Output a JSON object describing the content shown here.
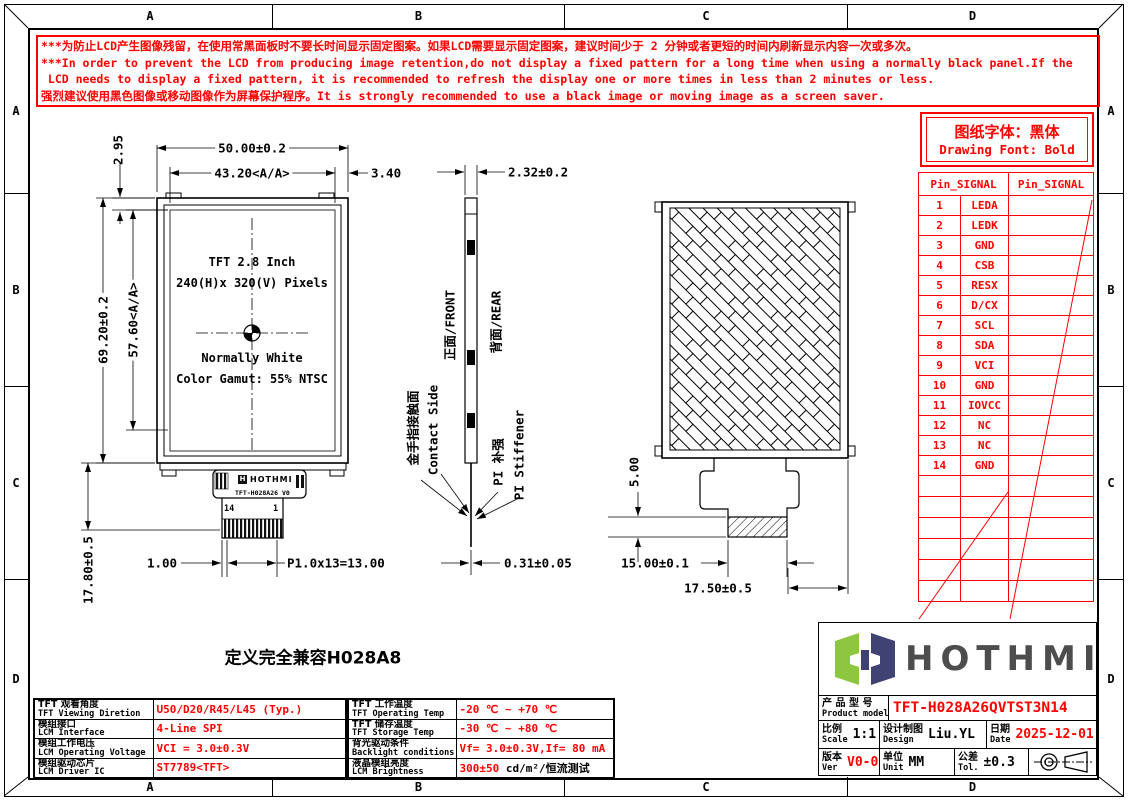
{
  "colors": {
    "red": "#ff0000",
    "logo_green": "#8dc63f",
    "logo_navy": "#3f4273",
    "logo_text": "#4d4d4d"
  },
  "grid": {
    "top": [
      "A",
      "B",
      "C",
      "D"
    ],
    "bottom": [
      "A",
      "B",
      "C",
      "D"
    ],
    "left": [
      "A",
      "B",
      "C",
      "D"
    ],
    "right": [
      "A",
      "B",
      "C",
      "D"
    ]
  },
  "warning": {
    "lines": [
      "***为防止LCD产生图像残留，在使用常黑面板时不要长时间显示固定图案。如果LCD需要显示固定图案，建议时间少于 2 分钟或者更短的时间内刷新显示内容一次或多次。",
      "***In order to prevent the LCD from producing image retention,do not display a fixed pattern for a long time when using a normally black panel.If the",
      " LCD needs to display a fixed pattern, it is recommended to refresh the display one or more times in less than 2 minutes or less.",
      "强烈建议使用黑色图像或移动图像作为屏幕保护程序。It is strongly recommended to use a black image or moving image as a screen saver."
    ]
  },
  "front_view": {
    "dim_width": "50.00±0.2",
    "dim_width_aa": "43.20<A/A>",
    "dim_side_margin": "3.40",
    "dim_top_margin": "2.95",
    "dim_height": "69.20±0.2",
    "dim_height_aa": "57.60<A/A>",
    "dim_tail": "17.80±0.5",
    "dim_pin_edge": "1.00",
    "dim_pitch": "P1.0x13=13.00",
    "screen_lines_top": [
      "TFT 2.8 Inch",
      "240(H)x 320(V) Pixels"
    ],
    "screen_lines_bottom": [
      "Normally White",
      "Color Gamut: 55% NTSC"
    ],
    "fpc_brand": "HOTHMI",
    "fpc_logo_letter": "H",
    "fpc_model": "TFT-H028A26 V0",
    "pin_first": "14",
    "pin_last": "1"
  },
  "side_view": {
    "dim_thickness": "2.32±0.2",
    "dim_fpc_thickness": "0.31±0.05",
    "label_front": "正面/FRONT",
    "label_rear": "背面/REAR",
    "label_contact_cn": "金手指接触面",
    "label_contact_en": "Contact Side",
    "label_stiffener_cn": "PI 补强",
    "label_stiffener_en": "PI Stiffener"
  },
  "rear_view": {
    "dim_stiffener_h": "5.00",
    "dim_stiffener_w": "15.00±0.1",
    "dim_tail_w": "17.50±0.5"
  },
  "font_note": {
    "cn": "图纸字体：黑体",
    "en": "Drawing Font: Bold"
  },
  "pin_table": {
    "header_left": "Pin_SIGNAL",
    "header_right": "Pin_SIGNAL",
    "pins": [
      {
        "no": "1",
        "signal": "LEDA"
      },
      {
        "no": "2",
        "signal": "LEDK"
      },
      {
        "no": "3",
        "signal": "GND"
      },
      {
        "no": "4",
        "signal": "CSB"
      },
      {
        "no": "5",
        "signal": "RESX"
      },
      {
        "no": "6",
        "signal": "D/CX"
      },
      {
        "no": "7",
        "signal": "SCL"
      },
      {
        "no": "8",
        "signal": "SDA"
      },
      {
        "no": "9",
        "signal": "VCI"
      },
      {
        "no": "10",
        "signal": "GND"
      },
      {
        "no": "11",
        "signal": "IOVCC"
      },
      {
        "no": "12",
        "signal": "NC"
      },
      {
        "no": "13",
        "signal": "NC"
      },
      {
        "no": "14",
        "signal": "GND"
      }
    ]
  },
  "compat_note": "定义完全兼容H028A8",
  "spec_table": {
    "left_rows": [
      {
        "label_cn": "TFT 观看角度",
        "label_en": "TFT Viewing Diretion",
        "value": "U50/D20/R45/L45 (Typ.)"
      },
      {
        "label_cn": "模组接口",
        "label_en": "LCM Interface",
        "value": "4-Line SPI"
      },
      {
        "label_cn": "模组工作电压",
        "label_en": "LCM Operating Voltage",
        "value": "VCI = 3.0±0.3V"
      },
      {
        "label_cn": "模组驱动芯片",
        "label_en": "LCM Driver IC",
        "value": "ST7789<TFT>"
      }
    ],
    "right_rows": [
      {
        "label_cn": "TFT 工作温度",
        "label_en": "TFT Operating Temp",
        "value": "-20 ℃ ~ +70 ℃"
      },
      {
        "label_cn": "TFT 储存温度",
        "label_en": "TFT Storage Temp",
        "value": "-30 ℃ ~ +80 ℃"
      },
      {
        "label_cn": "背光驱动条件",
        "label_en": "Backlight conditions",
        "value": "Vf= 3.0±0.3V,If= 80 mA"
      },
      {
        "label_cn": "液晶模组亮度",
        "label_en": "LCM Brightness",
        "value": "300±50",
        "value_suffix": " cd/m²/恒流测试"
      }
    ]
  },
  "title_block": {
    "logo_text": "HOTHMI",
    "product_label_cn": "产 品 型 号",
    "product_label_en": "Product model",
    "product_model": "TFT-H028A26QVTST3N14",
    "scale_cn": "比例",
    "scale_en": "Scale",
    "scale_value": "1:1",
    "design_cn": "设计制图",
    "design_en": "Design",
    "design_value": "Liu.YL",
    "date_cn": "日期",
    "date_en": "Date",
    "date_value": "2025-12-01",
    "ver_cn": "版本",
    "ver_en": "Ver",
    "ver_value": "V0-0",
    "unit_cn": "单位",
    "unit_en": "Unit",
    "unit_value": "MM",
    "tol_cn": "公差",
    "tol_en": "Tol.",
    "tol_value": "±0.3"
  }
}
